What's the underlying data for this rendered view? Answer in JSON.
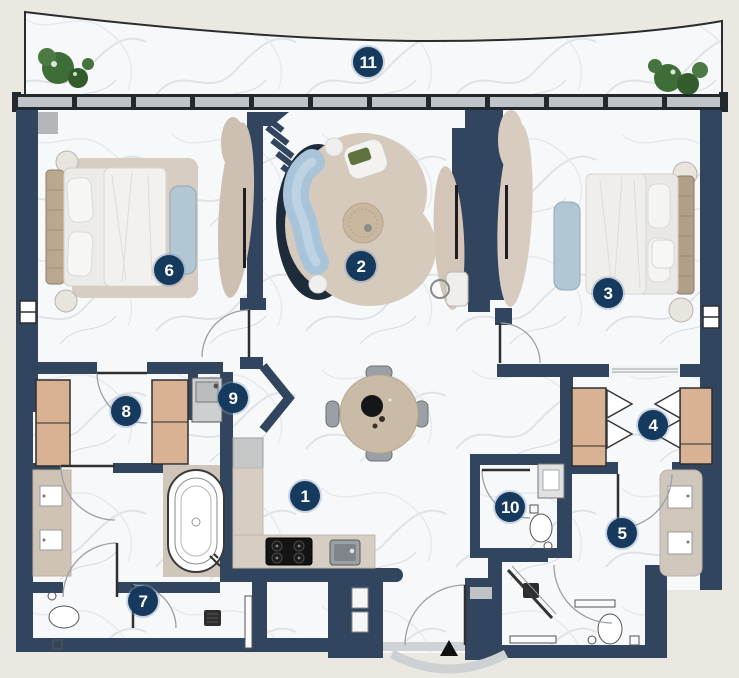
{
  "floor_plan": {
    "badges": [
      {
        "num": "1"
      },
      {
        "num": "2"
      },
      {
        "num": "3"
      },
      {
        "num": "4"
      },
      {
        "num": "5"
      },
      {
        "num": "6"
      },
      {
        "num": "7"
      },
      {
        "num": "8"
      },
      {
        "num": "9"
      },
      {
        "num": "10"
      },
      {
        "num": "11"
      }
    ],
    "colors": {
      "wall": "#31465e",
      "badge": "#16395e",
      "floor": "#f7f8fa",
      "outside": "#ebe8e1",
      "rug": "#d6cabc",
      "wardrobe_wood": "#d9b193",
      "upholstery_blue": "#a9c4d8",
      "plant_green": "#3f6d38",
      "counter": "#d6cdc3",
      "window_glass": "#bfc4c8",
      "cooktop": "#141414"
    }
  }
}
